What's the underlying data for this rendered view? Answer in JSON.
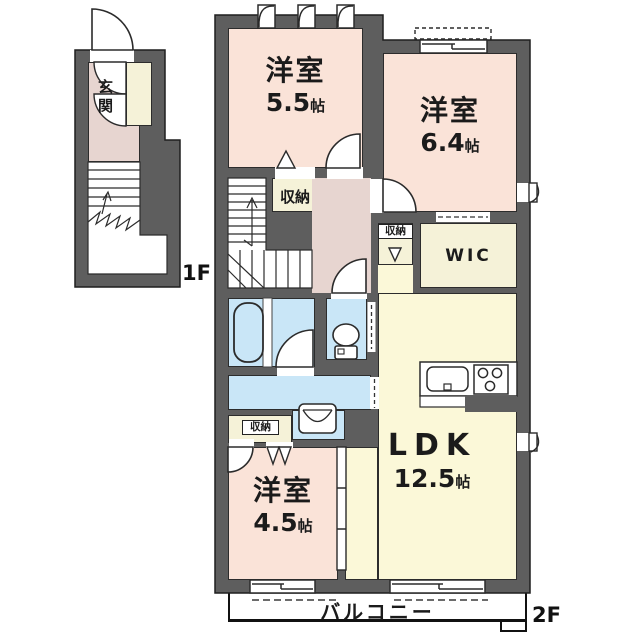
{
  "colors": {
    "wall": "#5e5e5e",
    "bedroom_floor": "#fae3d8",
    "hallway_floor": "#e7d5d0",
    "storage_floor": "#f5f2d8",
    "ldk_floor": "#fbf8d8",
    "wet_area_floor": "#c9e6f7",
    "balcony": "#ffffff",
    "outline": "#2c2c2c"
  },
  "floors": {
    "f1": {
      "label": "1F",
      "rooms": {
        "genkan": {
          "name": "玄関"
        }
      }
    },
    "f2": {
      "label": "2F",
      "rooms": {
        "bedroom1": {
          "name": "洋室",
          "size": "5.5",
          "unit": "帖"
        },
        "bedroom2": {
          "name": "洋室",
          "size": "6.4",
          "unit": "帖"
        },
        "bedroom3": {
          "name": "洋室",
          "size": "4.5",
          "unit": "帖"
        },
        "ldk": {
          "name": "LDK",
          "size": "12.5",
          "unit": "帖"
        },
        "wic": {
          "name": "WIC"
        },
        "storage_b1": {
          "name": "収納"
        },
        "storage_ldk": {
          "name": "収納"
        },
        "storage_b3": {
          "name": "収納"
        },
        "balcony": {
          "name": "バルコニー"
        }
      }
    }
  }
}
